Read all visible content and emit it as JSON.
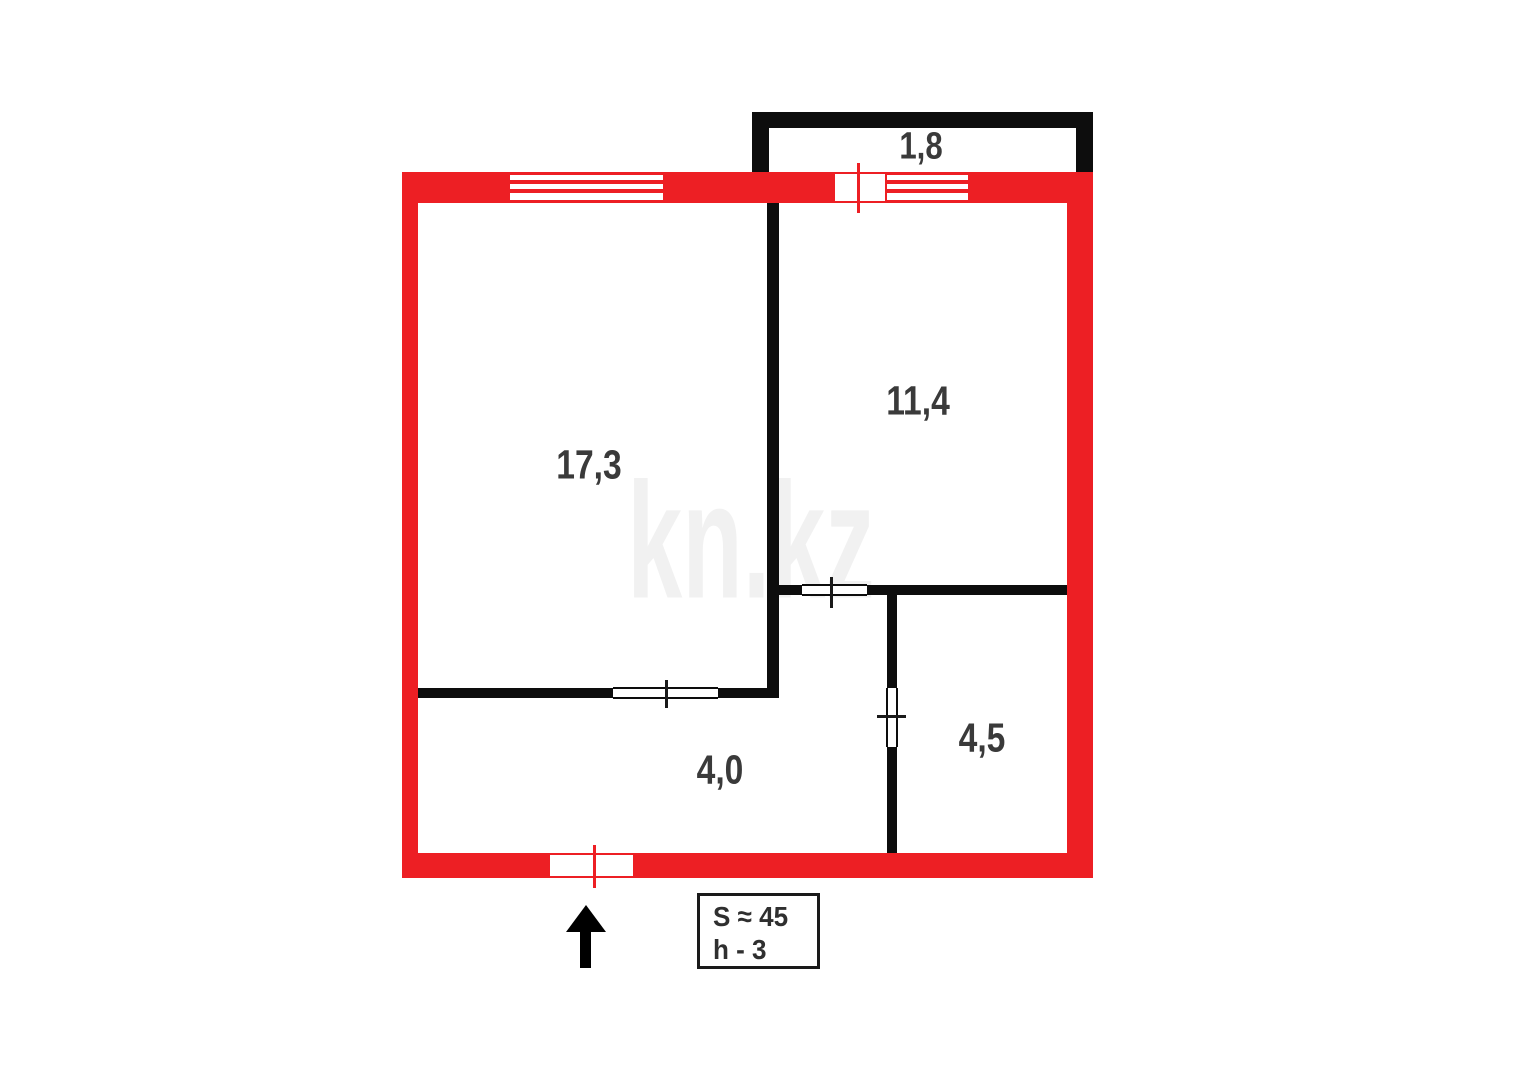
{
  "title": "apartment floor plan",
  "watermark": {
    "text": "kn.kz",
    "color": "#f1f1f1"
  },
  "colors": {
    "exterior_wall": "#ed1f24",
    "interior_wall": "#0d0d0d",
    "label_text": "#3a3a3a",
    "background": "#ffffff"
  },
  "rooms": [
    {
      "name": "living-room",
      "area_label": "17,3"
    },
    {
      "name": "bedroom",
      "area_label": "11,4"
    },
    {
      "name": "hallway",
      "area_label": "4,0"
    },
    {
      "name": "bathroom",
      "area_label": "4,5"
    },
    {
      "name": "balcony",
      "area_label": "1,8"
    }
  ],
  "legend": {
    "line1": "S ≈ 45",
    "line2": "h - 3"
  },
  "icons": {
    "entrance_arrow": "arrow-up-icon"
  }
}
